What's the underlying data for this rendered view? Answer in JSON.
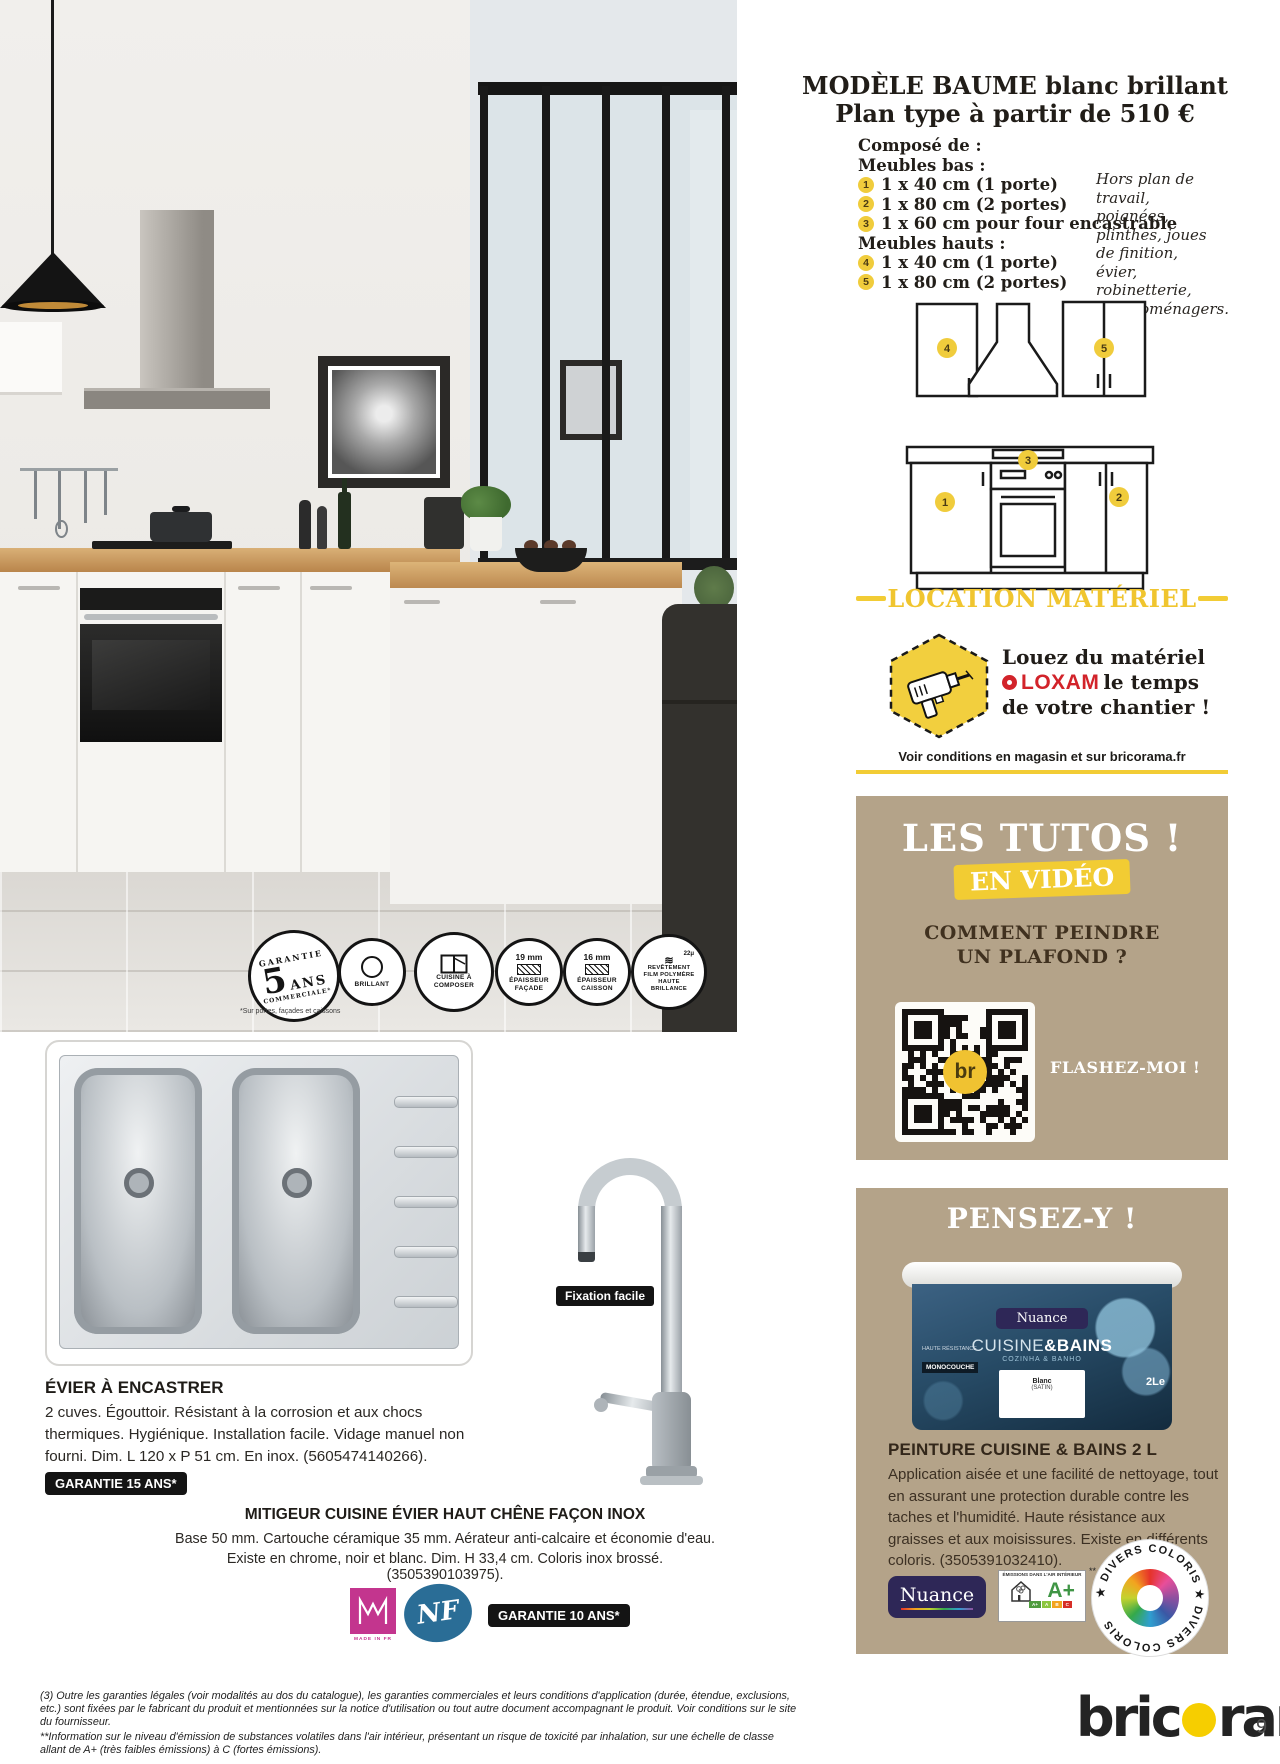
{
  "model_panel": {
    "title_line1": "MODÈLE BAUME blanc brillant",
    "title_line2": "Plan type à partir de 510 €",
    "composed_label": "Composé de :",
    "group_bas_label": "Meubles bas :",
    "item1_num": "1",
    "item1_text": "1 x 40 cm (1 porte)",
    "item2_num": "2",
    "item2_text": "1 x 80 cm (2 portes)",
    "item3_num": "3",
    "item3_text": "1 x 60 cm pour four encastrable",
    "group_hauts_label": "Meubles hauts :",
    "item4_num": "4",
    "item4_text": "1 x 40 cm (1 porte)",
    "item5_num": "5",
    "item5_text": "1 x 80 cm (2 portes)",
    "aside_note": "Hors plan de travail, poignées, plinthes, joues de finition, évier, robinetterie, électroménagers.",
    "diagram": {
      "n1": "1",
      "n2": "2",
      "n3": "3",
      "n4": "4",
      "n5": "5"
    }
  },
  "location": {
    "heading": "LOCATION MATÉRIEL",
    "line1": "Louez du matériel",
    "brand": "LOXAM",
    "line2_rest": "le temps",
    "line3": "de votre chantier !",
    "conditions": "Voir conditions en magasin et sur bricorama.fr"
  },
  "tutos": {
    "title": "LES TUTOS !",
    "tag": "EN VIDÉO",
    "question_line1": "COMMENT PEINDRE",
    "question_line2": "UN PLAFOND ?",
    "qr_center": "br",
    "flash_label": "FLASHEZ-MOI !"
  },
  "pensez": {
    "heading": "PENSEZ-Y !",
    "product_title": "PEINTURE CUISINE & BAINS 2 L",
    "description": "Application aisée et une facilité de nettoyage, tout en assurant une protection durable contre les taches et l'humidité. Haute résistance aux graisses et aux moisissures. Existe en différents coloris. (3505391032410).",
    "bucket": {
      "brand": "Nuance",
      "range_light": "CUISINE",
      "range_bold": "&BAINS",
      "range_sub": "COZINHA & BANHO",
      "haute": "HAUTE RÉSISTANCE",
      "mono_tag": "MONOCOUCHE",
      "label_line1": "Blanc",
      "label_line2": "(SATIN)",
      "volume": "2Le"
    },
    "logos": {
      "nuance": "Nuance",
      "aplus_header": "ÉMISSIONS DANS L'AIR INTÉRIEUR",
      "aplus_sup": "**",
      "aplus_value": "A+",
      "scale_a_plus": "A+",
      "scale_a": "A",
      "scale_b": "B",
      "scale_c": "C",
      "divers_text": "★ DIVERS COLORIS ★ DIVERS COLORIS"
    }
  },
  "badges": {
    "stamp_top": "GARANTIE",
    "stamp_big": "5",
    "stamp_mid": "ANS",
    "stamp_bottom": "COMMERCIALE*",
    "b2": "BRILLANT",
    "b3_line1": "CUISINE À",
    "b3_line2": "COMPOSER",
    "b4_mm": "19 mm",
    "b4_label": "ÉPAISSEUR FAÇADE",
    "b5_mm": "16 mm",
    "b5_label": "ÉPAISSEUR CAISSON",
    "b6_micro": "22μ",
    "b6_label": "REVÊTEMENT FILM POLYMÈRE HAUTE BRILLANCE",
    "note": "*Sur portes, façades et caissons"
  },
  "sink": {
    "title": "ÉVIER À ENCASTRER",
    "description": "2 cuves. Égouttoir. Résistant à la corrosion et aux chocs thermiques. Hygiénique. Installation facile. Vidage manuel non fourni. Dim. L 120 x P 51 cm. En inox. (5605474140266).",
    "warranty": "GARANTIE 15 ANS*"
  },
  "faucet": {
    "tag": "Fixation facile",
    "title": "MITIGEUR CUISINE ÉVIER HAUT CHÊNE FAÇON INOX",
    "description1": "Base 50 mm. Cartouche céramique 35 mm. Aérateur anti-calcaire et économie d'eau.",
    "description2": "Existe en chrome, noir et blanc. Dim. H 33,4 cm. Coloris inox brossé. (3505390103975).",
    "warranty": "GARANTIE 10 ANS*",
    "nf_label": "NF",
    "m_caption": "MADE IN FR"
  },
  "footer": {
    "legal1": "(3) Outre les garanties légales (voir modalités au dos du catalogue), les garanties commerciales et leurs conditions d'application (durée, étendue, exclusions, etc.) sont fixées par le fabricant du produit et mentionnées sur la notice d'utilisation ou tout autre document accompagnant le produit. Voir conditions sur le site du fournisseur.",
    "legal2": "**Information sur le niveau d'émission de substances volatiles dans l'air intérieur, présentant un risque de toxicité par inhalation, sur une échelle de classe allant de A+ (très faibles émissions) à C (fortes émissions).",
    "brand_pre": "bric",
    "brand_post": "rama",
    "page_number": "9"
  }
}
